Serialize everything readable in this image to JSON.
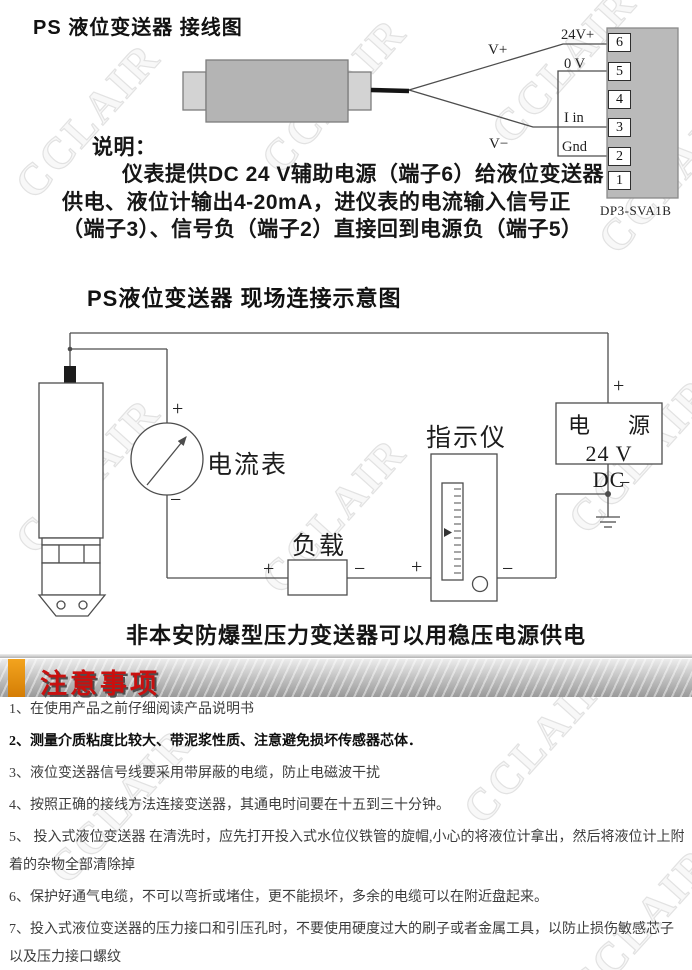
{
  "watermark": "CCLAIR",
  "signs": {
    "plus": "+",
    "minus": "−"
  },
  "wiring": {
    "title": "PS 液位变送器 接线图",
    "wire_labels": {
      "v_plus": "V+",
      "v_minus": "V−",
      "t_24v": "24V+",
      "t_0v": "0 V",
      "t_iin": "I in",
      "t_gnd": "Gnd"
    },
    "terminals": [
      "6",
      "5",
      "4",
      "3",
      "2",
      "1"
    ],
    "model": "DP3-SVA1B",
    "explain": {
      "heading": "说明：",
      "lines": [
        "仪表提供DC 24 V辅助电源（端子6）给液位变送器",
        "供电、液位计输出4-20mA，进仪表的电流输入信号正",
        "（端子3）、信号负（端子2）直接回到电源负（端子5）"
      ]
    }
  },
  "field": {
    "title": "PS液位变送器 现场连接示意图",
    "ammeter": "电流表",
    "load": "负载",
    "indicator": "指示仪",
    "power": {
      "name_left": "电",
      "name_right": "源",
      "rating": "24 V DC"
    },
    "footnote": "非本安防爆型压力变送器可以用稳压电源供电"
  },
  "notice": {
    "title": "注意事项",
    "items": [
      "1、在使用产品之前仔细阅读产品说明书",
      "2、测量介质粘度比较大、带泥浆性质、注意避免损坏传感器芯体．",
      "3、液位变送器信号线要采用带屏蔽的电缆，防止电磁波干扰",
      "4、按照正确的接线方法连接变送器，其通电时间要在十五到三十分钟。",
      "5、 投入式液位变送器 在清洗时，应先打开投入式水位仪铁管的旋帽,小心的将液位计拿出，然后将液位计上附着的杂物全部清除掉",
      "6、保护好通气电缆，不可以弯折或堵住，更不能损坏，多余的电缆可以在附近盘起来。",
      "7、投入式液位变送器的压力接口和引压孔时，不要使用硬度过大的刷子或者金属工具，以防止损伤敏感芯子以及压力接口螺纹"
    ]
  }
}
